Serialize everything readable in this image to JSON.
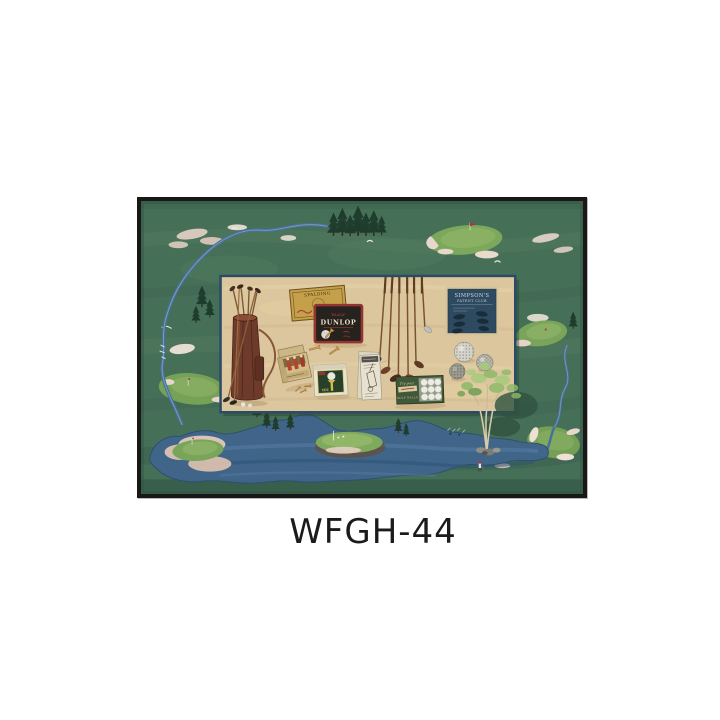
{
  "page": {
    "background_color": "#ffffff"
  },
  "product": {
    "code": "WFGH-44"
  },
  "artwork": {
    "description": "Framed print of vintage golf memorabilia panel over a painted golf-course map",
    "frame_color": "#191817",
    "labels": {
      "spalding_tin": "SPALDING",
      "dunlop_tin_sub": "'BLACK'",
      "dunlop_tin": "DUNLOP",
      "simpsons_sign_line1": "SIMPSON'S",
      "simpsons_sign_line2": "PATENT CLUB",
      "ball_box_script": "Try your",
      "ball_box_name": "GOLF BALLS",
      "tee_box_label": "TEE"
    },
    "colors": {
      "course_green": "#466f58",
      "putting_green": "#7ca85c",
      "water_blue": "#40658b",
      "bunker_sand": "#e3d0c4",
      "panel_beige": "#dcc69d",
      "panel_border": "#2b4a68",
      "spalding_gold": "#c5a04a",
      "dunlop_black": "#26221e",
      "dunlop_red": "#953232",
      "sign_navy": "#2e4a60",
      "bag_leather": "#6e3a2b"
    }
  }
}
